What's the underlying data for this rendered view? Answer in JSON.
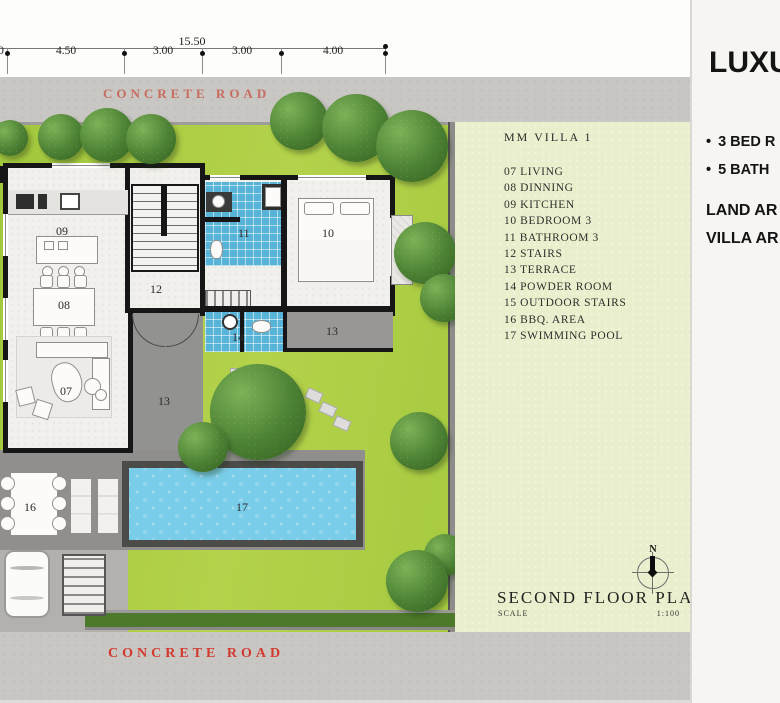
{
  "dims": {
    "total": "15.50",
    "labels": [
      "0",
      "4.50",
      "3.00",
      "3.00",
      "4.00"
    ]
  },
  "roads": {
    "top": "CONCRETE  ROAD",
    "bottom": "CONCRETE  ROAD"
  },
  "legend": {
    "title": "MM  VILLA 1",
    "items": [
      "07 LIVING",
      "08 DINNING",
      "09 KITCHEN",
      "10 BEDROOM 3",
      "11 BATHROOM 3",
      "12 STAIRS",
      "13 TERRACE",
      "14 POWDER ROOM",
      "15 OUTDOOR STAIRS",
      "16 BBQ. AREA",
      "17 SWIMMING POOL"
    ]
  },
  "plan_labels": {
    "kitchen": "09",
    "dinning": "08",
    "living": "07",
    "stairs": "12",
    "bathroom": "11",
    "bedroom": "10",
    "terrace_upper": "13",
    "terrace_side": "13",
    "powder": "14",
    "bbq": "16",
    "pool": "17"
  },
  "titleblock": {
    "north": "N",
    "title": "SECOND  FLOOR  PLAN",
    "scale_label": "SCALE",
    "scale_value": "1:100"
  },
  "marketing": {
    "heading": "LUXU",
    "bullet": "•",
    "bullets": [
      "3 BED R",
      "5 BATH"
    ],
    "lines": [
      "LAND AR",
      "VILLA AR"
    ]
  },
  "colors": {
    "lawn": "#a8cb40",
    "panel_green": "#e9efcc",
    "road_gray": "#c9c7c4",
    "pool_water": "#79cde8",
    "tile_blue": "#58b3d8",
    "road_text_red": "#d23a30"
  }
}
